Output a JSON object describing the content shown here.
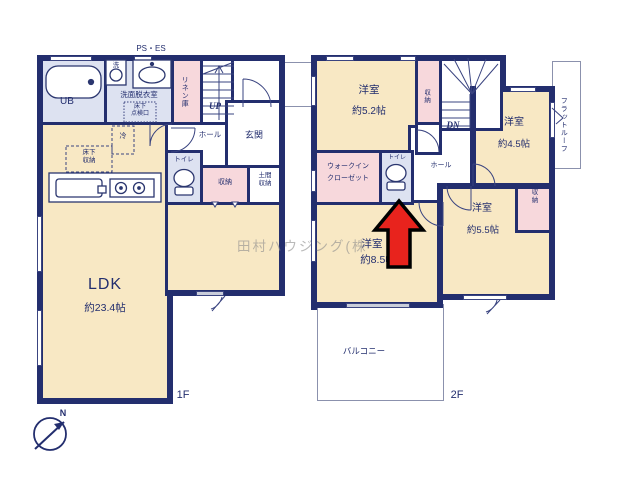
{
  "floor1": {
    "label": "1F",
    "ps_es": "PS・ES",
    "ub": "UB",
    "washroom": "洗面脱衣室",
    "inspection": "床下\n点検口",
    "linen": "リネン庫",
    "up": "UP",
    "hall": "ホール",
    "entrance": "玄関",
    "toilet": "トイレ",
    "storage": "収納",
    "doma": "土間\n収納",
    "washer": "洗",
    "fridge": "冷",
    "underfloor": "床下\n収納",
    "ldk": "LDK",
    "ldk_size": "約23.4帖"
  },
  "floor2": {
    "label": "2F",
    "dn": "DN",
    "room_a": "洋室",
    "room_a_size": "約5.2帖",
    "closet_a": "収納",
    "room_b": "洋室",
    "room_b_size": "約4.5帖",
    "flat_roof": "フラットルーフ",
    "wic_line1": "ウォークイン",
    "wic_line2": "クローゼット",
    "toilet": "トイレ",
    "hall": "ホール",
    "room_c": "洋室",
    "room_c_size": "約8.5帖",
    "room_d": "洋室",
    "room_d_size": "約5.5帖",
    "closet_d": "収\n納",
    "balcony": "バルコニー"
  },
  "compass": {
    "north": "N"
  },
  "watermark": "田村ハウジング(株",
  "colors": {
    "wall": "#232e6e",
    "room_cream": "#f8e8c4",
    "closet_pink": "#f7d8dc",
    "wet_blue": "#dde2f1",
    "highlight_arrow_red": "#e8231d"
  }
}
